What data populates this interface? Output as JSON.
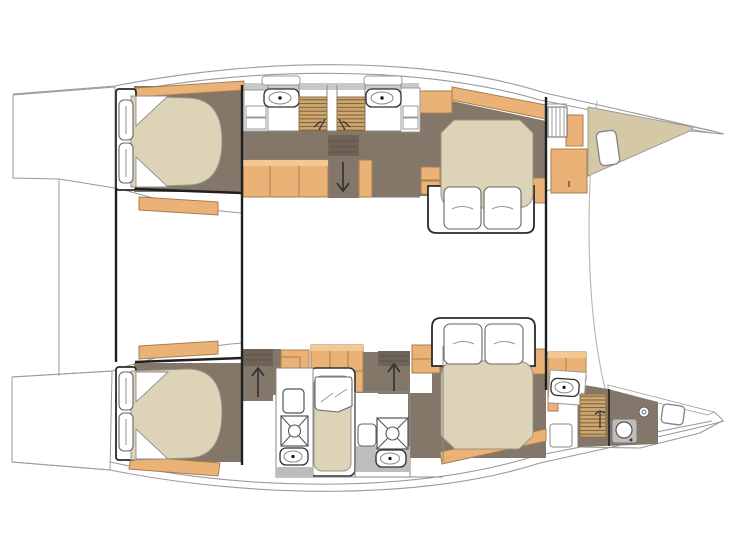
{
  "diagram": {
    "name": "catamaran-interior-layout-plan",
    "orientation": {
      "bow": "right",
      "stern": "left"
    },
    "hulls": [
      {
        "id": "upper-hull",
        "rooms": [
          "aft-double-cabin",
          "twin-shower-heads",
          "companionway-stairs-down",
          "forward-double-cabin",
          "foredeck-with-hatch"
        ]
      },
      {
        "id": "lower-hull",
        "rooms": [
          "aft-double-cabin",
          "aft-head-with-shower",
          "single-berth",
          "mid-head-with-shower",
          "companionway-stairs-up",
          "forward-double-cabin",
          "forward-head-with-toilet",
          "foredeck-with-hatch"
        ]
      }
    ],
    "fixtures": {
      "double_beds": 4,
      "single_berths": 1,
      "sinks": 5,
      "shower_trays": 2,
      "slatted_shower_floors": 3,
      "toilets": 1,
      "stair_flights": 3,
      "deck_hatches": 2
    }
  },
  "colors": {
    "background": "#ffffff",
    "floor": "#837769",
    "floor_dark": "#6e6356",
    "wood": "#ebb277",
    "wood_light": "#f3c993",
    "wood_stroke": "#a87f4e",
    "mattress": "#ddd3b7",
    "deck": "#d4c8a6",
    "slat_wood": "#cfa66d",
    "slat_line": "#77603f",
    "fixture_grey": "#bdbdbd",
    "counter_grey": "#c9c9c9",
    "line_dark": "#1f1f1f",
    "line_thin": "#9a9a9a",
    "wall": "#808080",
    "arrow": "#2f2f2f"
  }
}
